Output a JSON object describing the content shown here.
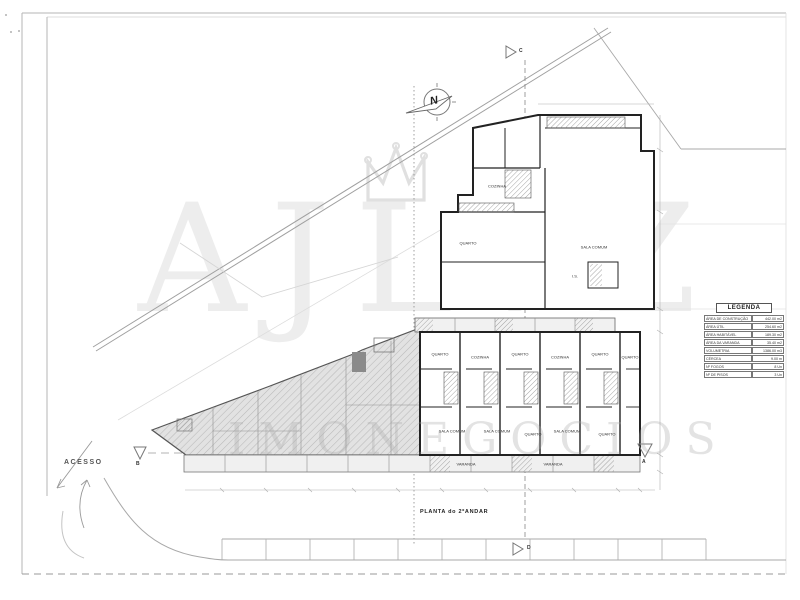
{
  "watermark": {
    "word": "AJLVZ",
    "subword": "IMONEGOCIOS"
  },
  "compass": {
    "letter": "N"
  },
  "markers": {
    "c": "C",
    "d": "D",
    "a": "A",
    "b": "B"
  },
  "labels": {
    "acesso": "ACESSO",
    "plan_title": "PLANTA do 2ºANDAR"
  },
  "legend": {
    "title": "LEGENDA",
    "rows": [
      {
        "label": "ÁREA DE CONSTRUÇÃO",
        "value": "442.00 m2"
      },
      {
        "label": "ÁREA ÚTIL",
        "value": "254.60 m2"
      },
      {
        "label": "ÁREA HABITÁVEL",
        "value": "189.30 m2"
      },
      {
        "label": "ÁREA DA VARANDA",
        "value": "35.40 m2"
      },
      {
        "label": "VOLUMETRIA",
        "value": "1386.00 m3"
      },
      {
        "label": "CÉRCEA",
        "value": "9.00 m"
      },
      {
        "label": "Nº FOGOS",
        "value": "8 Un"
      },
      {
        "label": "Nº DE PISOS",
        "value": "3 Un"
      }
    ]
  },
  "rooms": [
    {
      "name": "COZINHA"
    },
    {
      "name": "QUARTO"
    },
    {
      "name": "SALA COMUM"
    },
    {
      "name": "I.S."
    },
    {
      "name": "QUARTO"
    },
    {
      "name": "COZINHA"
    },
    {
      "name": "QUARTO"
    },
    {
      "name": "COZINHA"
    },
    {
      "name": "QUARTO"
    },
    {
      "name": "QUARTO"
    },
    {
      "name": "SALA COMUM"
    },
    {
      "name": "SALA COMUM"
    },
    {
      "name": "QUARTO"
    },
    {
      "name": "SALA COMUM"
    },
    {
      "name": "QUARTO"
    },
    {
      "name": "VARANDA"
    },
    {
      "name": "VARANDA"
    }
  ]
}
